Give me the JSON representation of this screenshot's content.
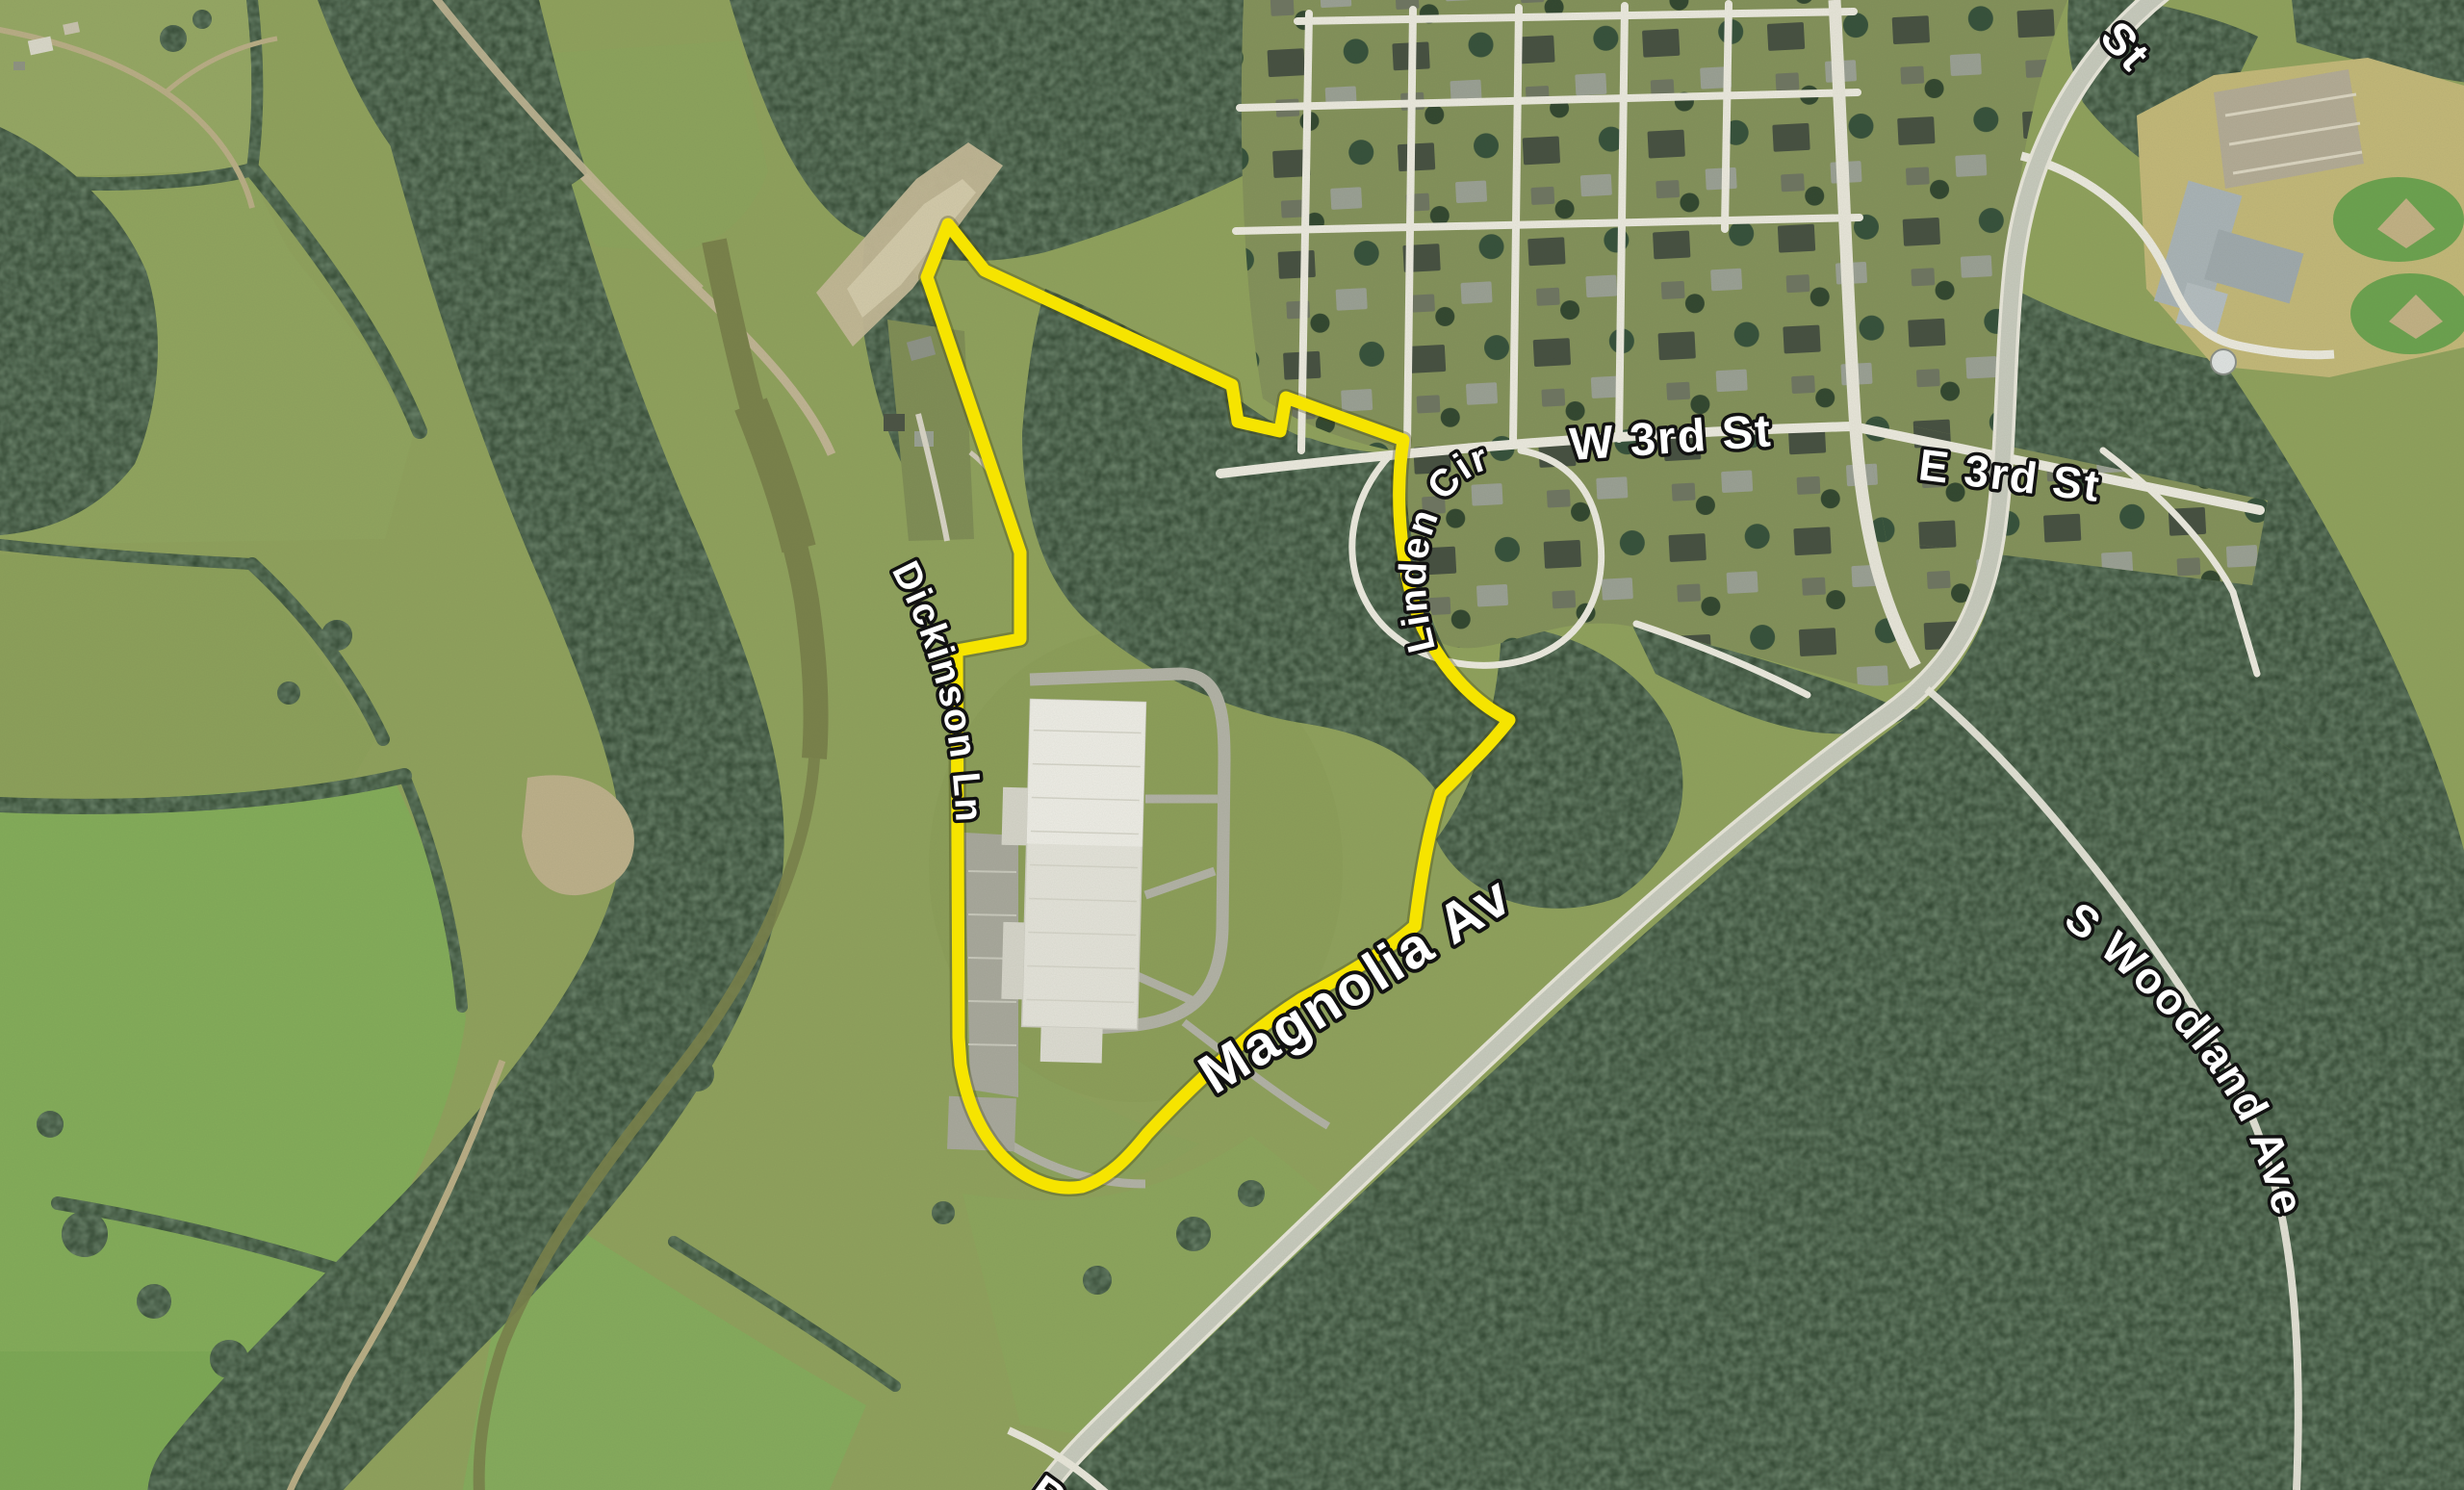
{
  "map": {
    "type": "aerial-satellite-view",
    "street_labels": {
      "w_3rd_st": "W 3rd St",
      "e_3rd_st": "E 3rd St",
      "linden_cir": "Linden Cir",
      "dickinson_ln": "Dickinson Ln",
      "magnolia_ave": "Magnolia Ave",
      "s_woodland_ave": "S Woodland Ave",
      "st_partial_top": "St",
      "be_partial_bottom": "Be"
    },
    "parcel": {
      "outline_color": "#F6E400",
      "description": "Yellow boundary outline around industrial facility parcel"
    },
    "colors": {
      "field_green": "#8FA15C",
      "bright_field_green": "#7FA855",
      "forest_green": "#2E432F",
      "road_white": "#ECEADF",
      "highway_gray": "#C6C9BC",
      "dirt_tan": "#B9AD85",
      "water_olive": "#79814A",
      "factory_roof": "#E6E5DC",
      "label_text": "#FFFFFF",
      "label_outline": "#111111"
    }
  }
}
